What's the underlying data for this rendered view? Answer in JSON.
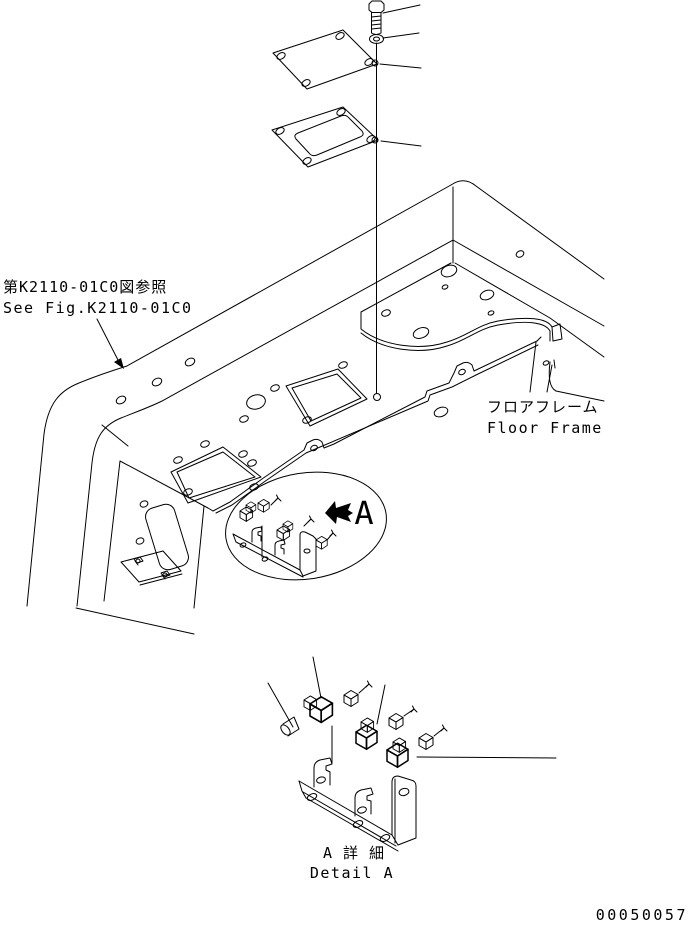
{
  "labels": {
    "reference_jp": "第K2110-01C0図参照",
    "reference_en": "See Fig.K2110-01C0",
    "floor_frame_jp": "フロアフレーム",
    "floor_frame_en": "Floor Frame",
    "detail_letter": "A",
    "detail_title_jp": "A 詳 細",
    "detail_title_en": "Detail A",
    "drawing_number": "00050057"
  },
  "style": {
    "line_color": "#000000",
    "background_color": "#ffffff"
  }
}
